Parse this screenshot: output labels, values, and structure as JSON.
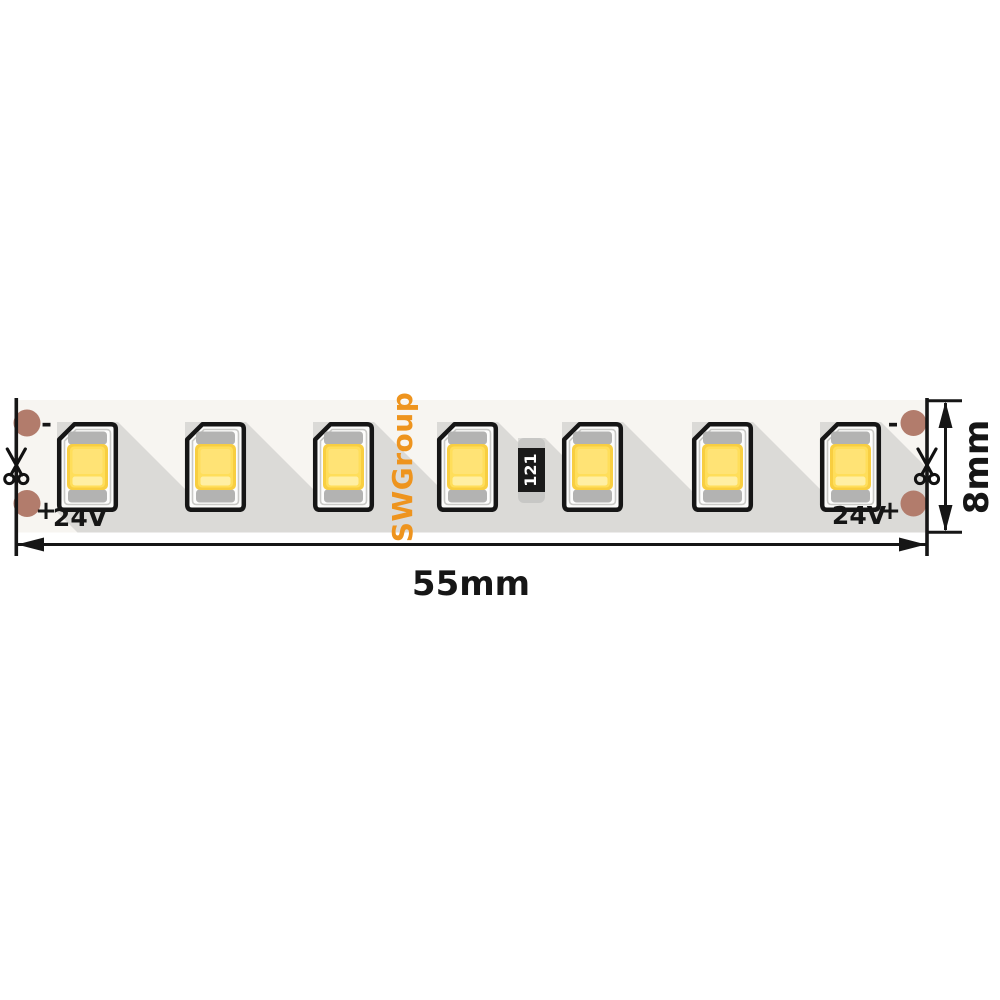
{
  "strip": {
    "brand": "SWGroup",
    "resistor_code": "121",
    "voltage": "24V",
    "polarity_plus": "+",
    "polarity_minus": "-",
    "led_count": 7,
    "colors": {
      "strip_background": "#F7F5F1",
      "shadow_gray": "#DBDAD7",
      "led_yellow_base": "#F8CE41",
      "led_yellow_mid": "#FFDE5A",
      "led_yellow_bright": "#FFE375",
      "led_yellow_pale_band": "#FFEFA3",
      "electrode_gray": "#B3B3B2",
      "pad_copper": "#B27C6C",
      "brand_orange": "#EE941E",
      "outline_black": "#161616"
    }
  },
  "dimensions": {
    "width_label": "55mm",
    "height_label": "8mm"
  },
  "icons": [
    "scissors-icon"
  ]
}
